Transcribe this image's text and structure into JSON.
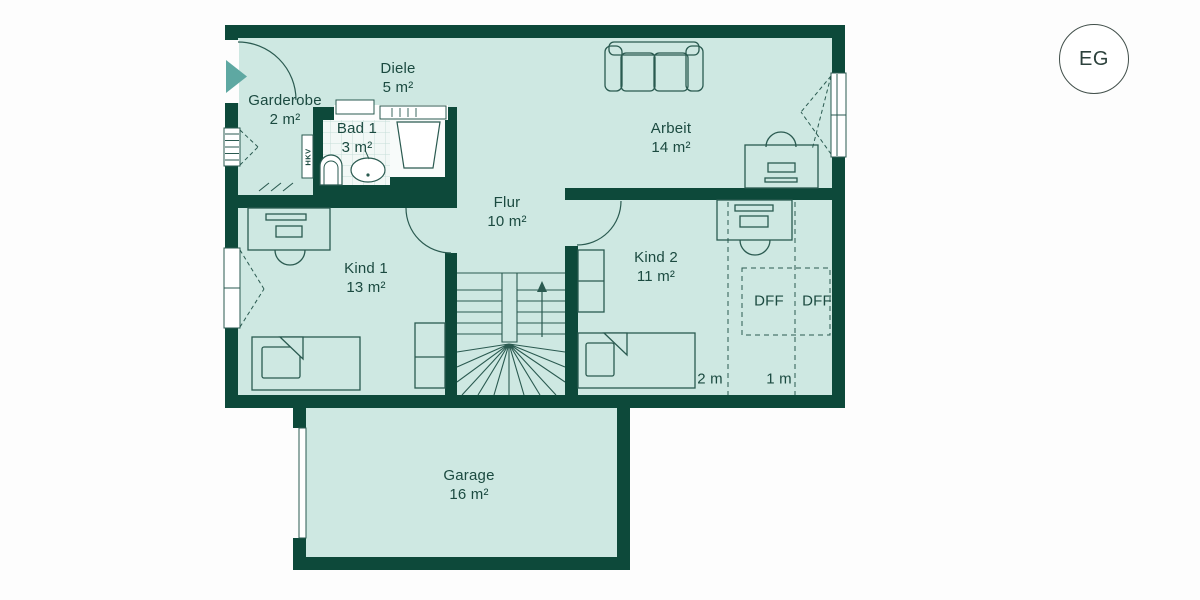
{
  "floor_badge": {
    "label": "EG"
  },
  "rooms": [
    {
      "name": "Diele",
      "area": "5 m²"
    },
    {
      "name": "Garderobe",
      "area": "2 m²"
    },
    {
      "name": "Bad 1",
      "area": "3 m²"
    },
    {
      "name": "Arbeit",
      "area": "14 m²"
    },
    {
      "name": "Flur",
      "area": "10 m²"
    },
    {
      "name": "Kind 1",
      "area": "13 m²"
    },
    {
      "name": "Kind 2",
      "area": "11 m²"
    },
    {
      "name": "Garage",
      "area": "16 m²"
    }
  ],
  "annotations": {
    "dff_left": "DFF",
    "dff_right": "DFF",
    "height_line_2m": "2 m",
    "height_line_1m": "1 m",
    "hkv": "HKV"
  },
  "icons": {
    "entrance_marker": "entrance-arrow-icon",
    "stairs_direction": "stairs-up-arrow-icon"
  },
  "colors": {
    "wall": "#0d493a",
    "floor": "#cee8e2",
    "bath_floor": "#f2f8f6",
    "line": "#2a5a50",
    "text": "#1b4a40",
    "entrance_arrow": "#5ea8a2",
    "background": "#fdfdfd"
  }
}
